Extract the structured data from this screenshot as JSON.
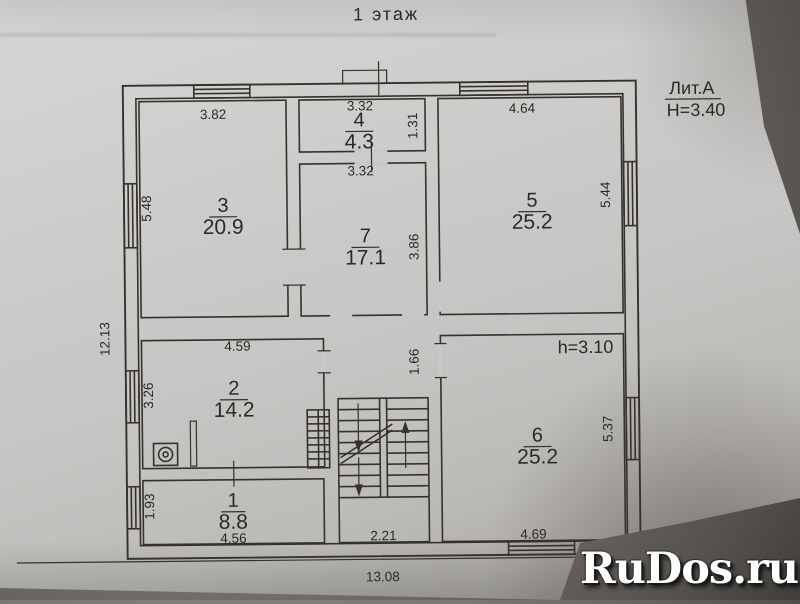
{
  "title": "1 этаж",
  "annotations": {
    "liter": "Лит.А",
    "building_height": "H=3.40",
    "ceiling_height": "h=3.10"
  },
  "watermark": "RuDos.ru",
  "overall": {
    "width": "13.08",
    "depth": "12.13"
  },
  "rooms": {
    "r1": {
      "number": "1",
      "area": "8.8",
      "width": "4.56",
      "depth": "1.93"
    },
    "r2": {
      "number": "2",
      "area": "14.2",
      "width": "4.59",
      "depth": "3.26"
    },
    "r3": {
      "number": "3",
      "area": "20.9",
      "width": "3.82",
      "depth": "5.48"
    },
    "r4": {
      "number": "4",
      "area": "4.3",
      "width": "3.32",
      "depth": "1.31"
    },
    "r5": {
      "number": "5",
      "area": "25.2",
      "width": "4.64",
      "depth": "5.44"
    },
    "r6": {
      "number": "6",
      "area": "25.2",
      "width": "4.69",
      "depth": "5.37"
    },
    "r7": {
      "number": "7",
      "area": "17.1",
      "width": "3.32",
      "depth": "3.86"
    }
  },
  "stairs": {
    "width": "2.21"
  },
  "hall": {
    "opening": "1.66"
  },
  "colors": {
    "paper": "#c8c7c5",
    "ink": "#35322e",
    "watermark": "#ffffff"
  }
}
